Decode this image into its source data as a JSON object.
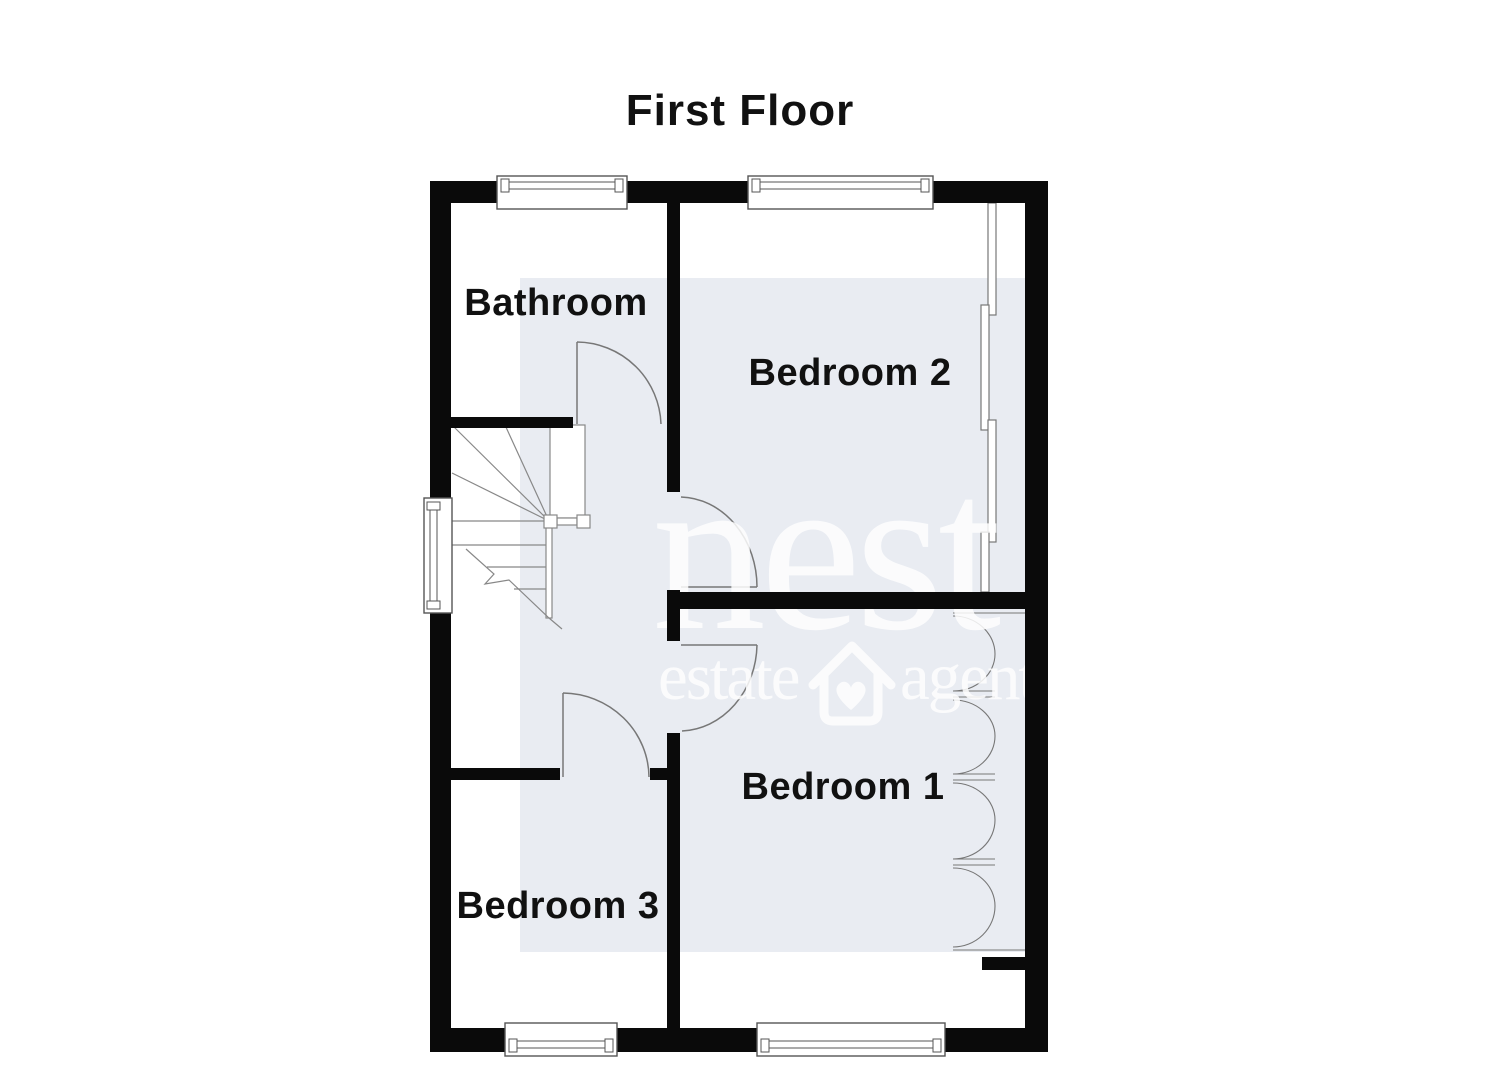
{
  "title": "First Floor",
  "rooms": {
    "bathroom": "Bathroom",
    "bedroom2": "Bedroom 2",
    "bedroom1": "Bedroom 1",
    "bedroom3": "Bedroom 3"
  },
  "watermark": {
    "brand": "nest",
    "word1": "estate",
    "word2": "agents",
    "icon": "house-heart-icon"
  },
  "colors": {
    "wall": "#0a0a0a",
    "line": "#777777",
    "highlight_box": "#e9ecf2",
    "watermark_text": "#ffffff",
    "label_text": "#111111",
    "background": "#ffffff"
  },
  "diagram": {
    "type": "floorplan",
    "features": [
      "window",
      "door-swing",
      "staircase-with-winders",
      "sliding-wardrobe-doors",
      "bifold-wardrobe-doors"
    ]
  }
}
